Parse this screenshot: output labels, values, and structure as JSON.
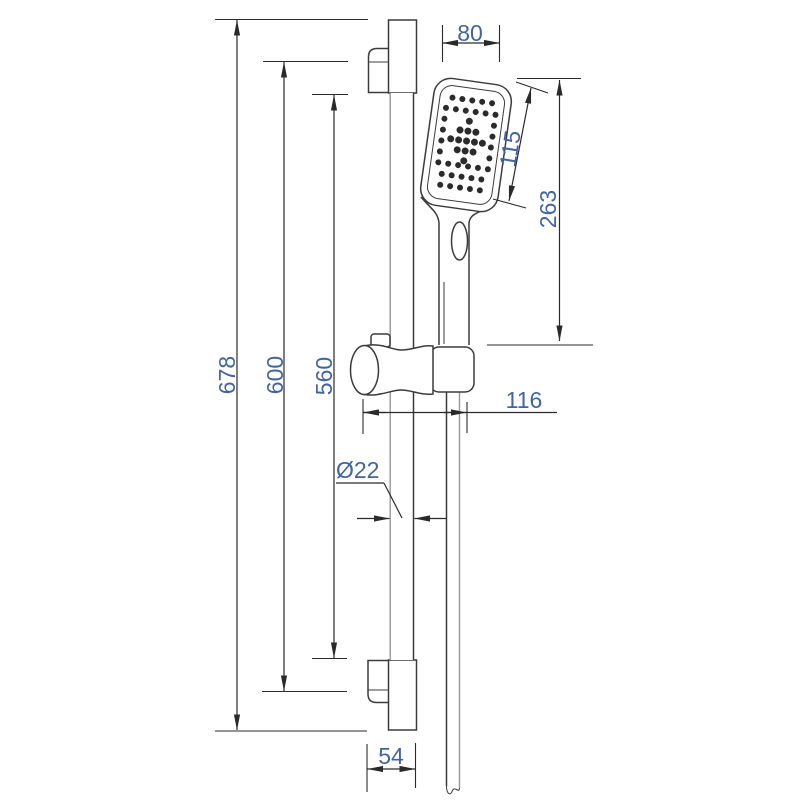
{
  "drawing": {
    "dimensions": {
      "total_height": "678",
      "mount_span": "600",
      "bar_span": "560",
      "head_width": "80",
      "head_face_length": "115",
      "head_to_holder": "263",
      "holder_reach": "116",
      "bar_diameter": "Ø22",
      "foot_width": "54"
    },
    "colors": {
      "drawing_line": "#3b3b3b",
      "dimension_line": "#2a2a2a",
      "dimension_text": "#4164a5",
      "background": "#ffffff"
    }
  }
}
